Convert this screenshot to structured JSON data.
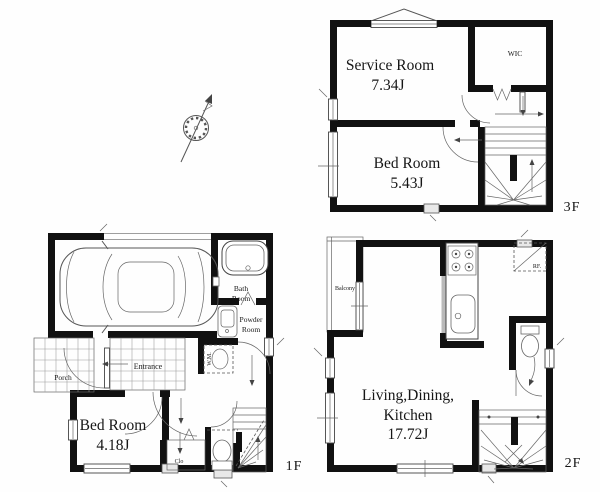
{
  "canvas": {
    "background": "#fefefe",
    "wall_color": "#111111",
    "line_color": "#555555"
  },
  "icons": {
    "compass": "north-compass-icon",
    "car": "car-top-view-icon",
    "stairs": "winder-stairs-icon"
  },
  "floor_3f": {
    "label": "3F",
    "service_room": {
      "name": "Service Room",
      "area": "7.34J"
    },
    "wic": {
      "name": "WIC"
    },
    "bed_room": {
      "name": "Bed Room",
      "area": "5.43J"
    }
  },
  "floor_2f": {
    "label": "2F",
    "ldk": {
      "line1": "Living,Dining,",
      "line2": "Kitchen",
      "area": "17.72J"
    },
    "balcony": {
      "name": "Balcony"
    },
    "refrigerator": {
      "name": "RF."
    }
  },
  "floor_1f": {
    "label": "1F",
    "bed_room": {
      "name": "Bed Room",
      "area": "4.18J"
    },
    "bath_room": {
      "line1": "Bath",
      "line2": "Room"
    },
    "powder_room": {
      "line1": "Powder",
      "line2": "Room"
    },
    "entrance": {
      "name": "Entrance"
    },
    "porch": {
      "name": "Porch"
    },
    "washing_machine": {
      "name": "W.M."
    },
    "closet": {
      "name": "Clo"
    }
  }
}
